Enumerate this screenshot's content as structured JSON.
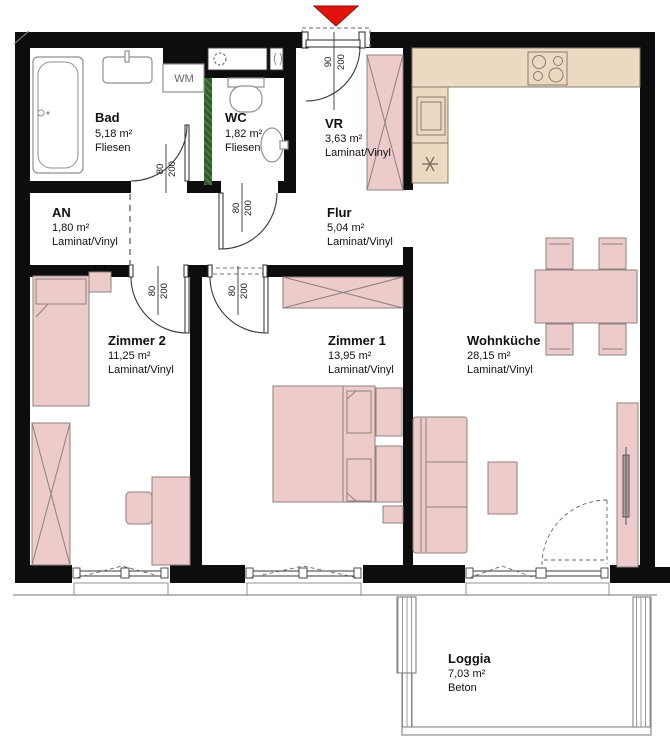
{
  "plan": {
    "rooms": [
      {
        "name": "Bad",
        "area": "5,18 m²",
        "floor": "Fliesen"
      },
      {
        "name": "WC",
        "area": "1,82 m²",
        "floor": "Fliesen"
      },
      {
        "name": "VR",
        "area": "3,63 m²",
        "floor": "Laminat/Vinyl"
      },
      {
        "name": "AN",
        "area": "1,80 m²",
        "floor": "Laminat/Vinyl"
      },
      {
        "name": "Flur",
        "area": "5,04 m²",
        "floor": "Laminat/Vinyl"
      },
      {
        "name": "Zimmer 2",
        "area": "11,25 m²",
        "floor": "Laminat/Vinyl"
      },
      {
        "name": "Zimmer 1",
        "area": "13,95 m²",
        "floor": "Laminat/Vinyl"
      },
      {
        "name": "Wohnküche",
        "area": "28,15 m²",
        "floor": "Laminat/Vinyl"
      },
      {
        "name": "Loggia",
        "area": "7,03 m²",
        "floor": "Beton"
      }
    ],
    "appliances": {
      "washing_machine": "WM"
    },
    "doors": {
      "entry": {
        "width": "90",
        "height": "200"
      },
      "bad": {
        "width": "80",
        "height": "200"
      },
      "wc": {
        "width": "80",
        "height": "200"
      },
      "zimmer2": {
        "width": "80",
        "height": "200"
      },
      "zimmer1": {
        "width": "80",
        "height": "200"
      }
    },
    "colors": {
      "wall": "#0d0d0d",
      "furniture": "#edcbca",
      "kitchen_counter": "#ecd9c2",
      "installation_shaft": "#2f5c2a",
      "entry_arrow": "#e0140c",
      "background": "#ffffff"
    }
  }
}
